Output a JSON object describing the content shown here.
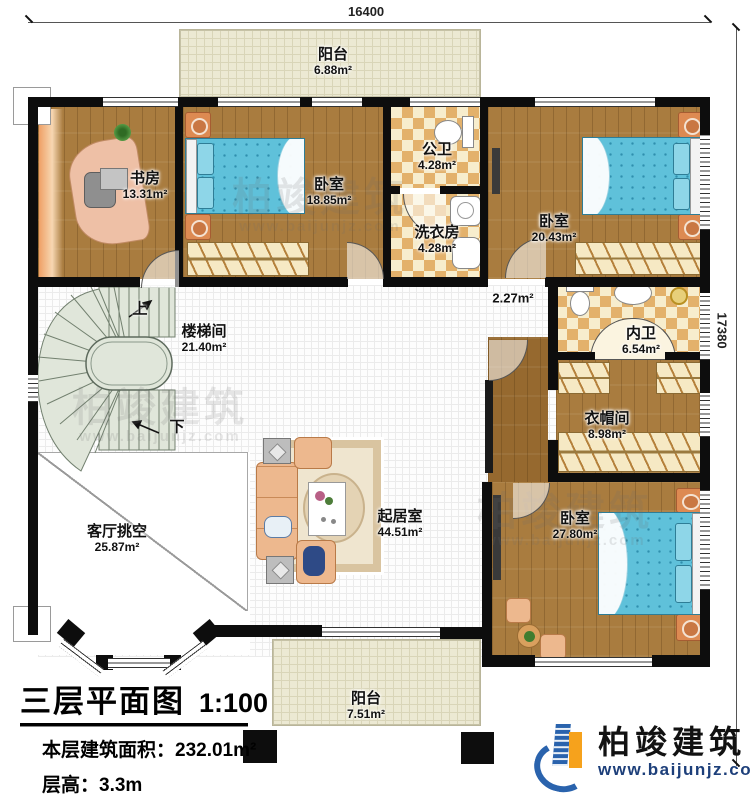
{
  "plan": {
    "dim_width": "16400",
    "dim_height": "17380",
    "stairs_up": "上",
    "stairs_down": "下",
    "rooms": {
      "balcony_top": {
        "name": "阳台",
        "area": "6.88m²"
      },
      "study": {
        "name": "书房",
        "area": "13.31m²"
      },
      "bedroom1": {
        "name": "卧室",
        "area": "18.85m²"
      },
      "public_bath": {
        "name": "公卫",
        "area": "4.28m²"
      },
      "laundry": {
        "name": "洗衣房",
        "area": "4.28m²"
      },
      "bedroom2": {
        "name": "卧室",
        "area": "20.43m²"
      },
      "stairwell": {
        "name": "楼梯间",
        "area": "21.40m²"
      },
      "corridor": {
        "area": "2.27m²"
      },
      "inner_bath": {
        "name": "内卫",
        "area": "6.54m²"
      },
      "cloakroom": {
        "name": "衣帽间",
        "area": "8.98m²"
      },
      "living_void": {
        "name": "客厅挑空",
        "area": "25.87m²"
      },
      "living_room": {
        "name": "起居室",
        "area": "44.51m²"
      },
      "bedroom3": {
        "name": "卧室",
        "area": "27.80m²"
      },
      "balcony_bottom": {
        "name": "阳台",
        "area": "7.51m²"
      }
    }
  },
  "title_block": {
    "title": "三层平面图",
    "scale": "1:100",
    "area_label": "本层建筑面积：",
    "area_value": "232.01m²",
    "height_label": "层高：",
    "height_value": "3.3m"
  },
  "branding": {
    "company": "柏竣建筑",
    "website": "www.baijunjz.com"
  },
  "watermark": {
    "text": "柏竣建筑",
    "site": "www.baijunjz.com"
  },
  "colors": {
    "wall": "#0d0d0d",
    "wood_floor": "#a97c3f",
    "tile_dark": "#e3b16b",
    "tile_light": "#f7edcd",
    "balcony_floor": "#ece9d3",
    "bed_blue": "#5fc1da",
    "logo_blue": "#2a63ad",
    "logo_orange": "#f6a21c"
  }
}
